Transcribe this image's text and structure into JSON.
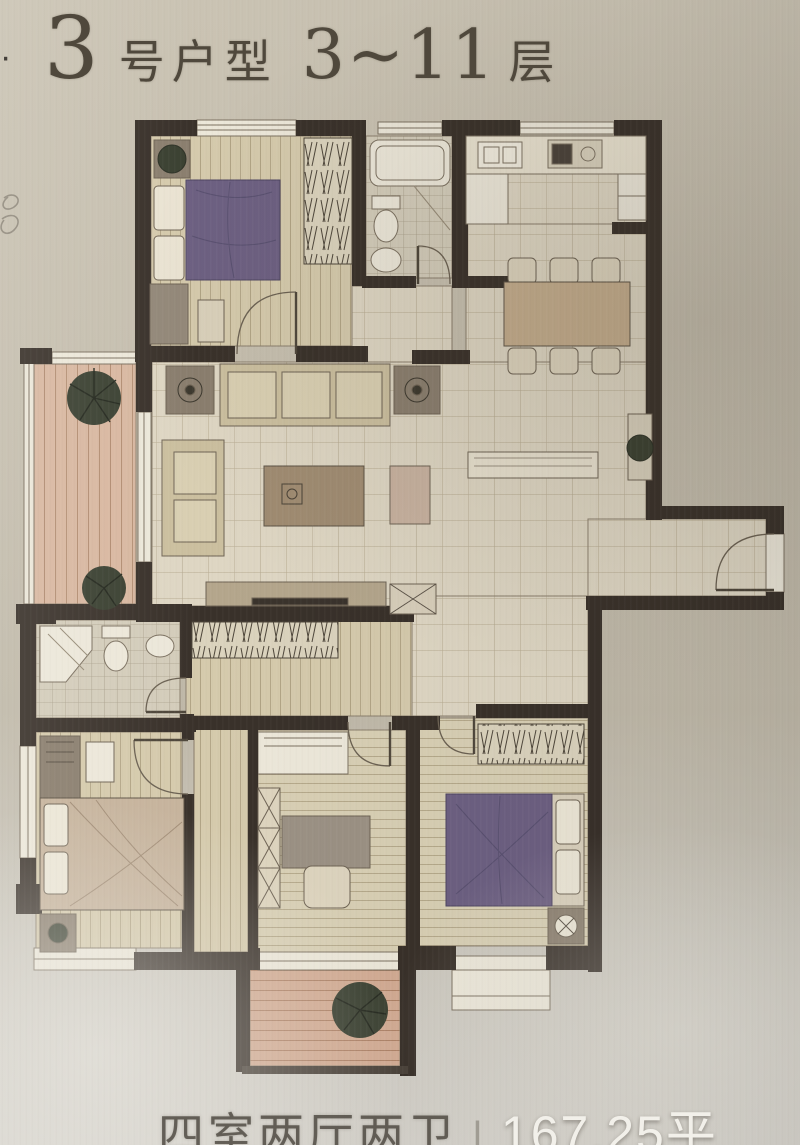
{
  "photo": {
    "kind": "apartment floor plan photo"
  },
  "title": {
    "bullet": "·",
    "unit_number": "3",
    "unit_label": "号户型",
    "floor_range": "3~11",
    "floor_label": "层"
  },
  "caption": {
    "layout": "四室两厅两卫",
    "separator": "|",
    "area": "167.25平"
  },
  "floor_plan": {
    "summary": {
      "unit": "3号",
      "floors": "3~11",
      "bedrooms": 4,
      "living_rooms": 2,
      "bathrooms": 2,
      "area_sqm": 167.25
    },
    "rooms": [
      {
        "id": "bedroom-top-left",
        "type": "bedroom",
        "furniture": [
          "double-bed",
          "wardrobe",
          "dresser",
          "bench",
          "plant-stand",
          "window"
        ]
      },
      {
        "id": "bathroom-top",
        "type": "bathroom",
        "furniture": [
          "bathtub",
          "toilet",
          "basin",
          "window"
        ]
      },
      {
        "id": "kitchen",
        "type": "kitchen",
        "furniture": [
          "counter",
          "sink",
          "cooktop",
          "refrigerator",
          "window"
        ]
      },
      {
        "id": "dining-room",
        "type": "dining",
        "furniture": [
          "dining-table",
          "six-chairs",
          "sideboard",
          "plant-stand"
        ]
      },
      {
        "id": "living-room",
        "type": "living",
        "furniture": [
          "sofa",
          "chaise",
          "coffee-table",
          "ottoman",
          "tv-cabinet",
          "two-plant-side-tables",
          "shoe-cabinet"
        ]
      },
      {
        "id": "balcony-left",
        "type": "balcony",
        "furniture": [
          "plant",
          "plant",
          "railing"
        ]
      },
      {
        "id": "entry-hall",
        "type": "entry",
        "furniture": [
          "entry-door"
        ]
      },
      {
        "id": "corridor",
        "type": "hallway",
        "furniture": [
          "built-in-closet"
        ]
      },
      {
        "id": "bathroom-lower",
        "type": "bathroom",
        "furniture": [
          "shower",
          "toilet",
          "basin"
        ]
      },
      {
        "id": "master-bedroom",
        "type": "bedroom",
        "furniture": [
          "double-bed",
          "wardrobe",
          "nightstand",
          "nightstand",
          "window"
        ]
      },
      {
        "id": "study-bedroom",
        "type": "bedroom",
        "furniture": [
          "desk",
          "chair",
          "cabinet",
          "bay-window",
          "balcony-slider"
        ]
      },
      {
        "id": "bedroom-bottom-right",
        "type": "bedroom",
        "furniture": [
          "double-bed",
          "wardrobe",
          "nightstand",
          "bay-window"
        ]
      },
      {
        "id": "balcony-bottom",
        "type": "balcony",
        "furniture": [
          "plant",
          "railing"
        ]
      }
    ]
  },
  "colors": {
    "paper": "#c4bdad",
    "wall": "#39312a",
    "tile_floor": "#ded6c3",
    "plank_floor": "#d5caac",
    "balcony_floor": "#d8b7a0",
    "bed_purple": "#6d6082",
    "furniture_tan": "#cbbf9f",
    "fixture_white": "#ece7d9",
    "plant_green": "#3a4031",
    "caption_white": "#f2f0ea",
    "caption_gray": "#49443c"
  }
}
